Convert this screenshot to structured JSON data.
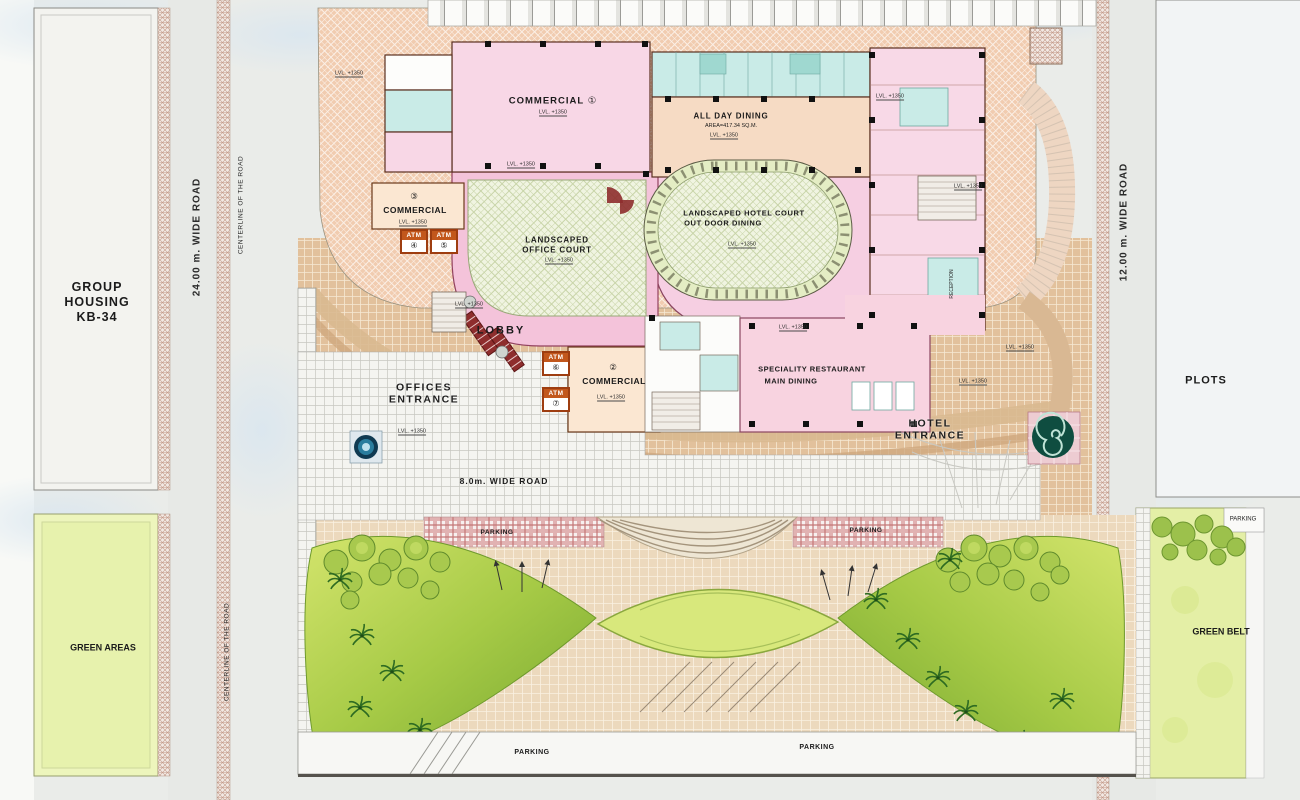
{
  "plan": {
    "surroundings": {
      "group_housing": {
        "line1": "GROUP",
        "line2": "HOUSING",
        "line3": "KB-34"
      },
      "left_road": "24.00 m. WIDE ROAD",
      "centerline_top": "CENTERLINE OF THE ROAD",
      "centerline_bottom": "CENTERLINE OF THE ROAD",
      "right_road": "12.00 m. WIDE ROAD",
      "plots": "PLOTS",
      "green_belt": "GREEN BELT",
      "green_areas": "GREEN AREAS",
      "green_belt_parking": "PARKING"
    },
    "building": {
      "commercial_1": {
        "number": "①",
        "label": "COMMERCIAL"
      },
      "commercial_2": {
        "number": "②",
        "label": "COMMERCIAL"
      },
      "commercial_3": {
        "number": "③",
        "label": "COMMERCIAL"
      },
      "all_day_dining": {
        "title": "ALL DAY DINING",
        "area": "AREA=417.34 SQ.M."
      },
      "hotel_court": {
        "line1": "LANDSCAPED HOTEL COURT",
        "line2": "OUT DOOR DINING"
      },
      "office_court": {
        "line1": "LANDSCAPED",
        "line2": "OFFICE COURT"
      },
      "specialty_restaurant": {
        "line1": "SPECIALITY RESTAURANT",
        "line2": "MAIN DINING"
      },
      "lobby": "LOBBY",
      "reception": "RECEPTION",
      "atm": {
        "label": "ATM",
        "numbers": [
          "④",
          "⑤",
          "⑥",
          "⑦"
        ]
      },
      "level_marker": "LVL. +1350"
    },
    "site": {
      "offices_entrance": {
        "line1": "OFFICES",
        "line2": "ENTRANCE"
      },
      "hotel_entrance": {
        "line1": "HOTEL",
        "line2": "ENTRANCE"
      },
      "internal_road": "8.0m. WIDE ROAD",
      "parking": "PARKING"
    },
    "colors": {
      "deck_peach": "#f1ccb0",
      "building_pink": "#f8d7e6",
      "service_cyan": "#c9ebe7",
      "commercial_cream": "#fbe7d2",
      "court_green": "#eef3de",
      "garden_green": "#8fb93c",
      "plaza_tan": "#e2c19c",
      "atm_orange": "#c2571c"
    }
  }
}
